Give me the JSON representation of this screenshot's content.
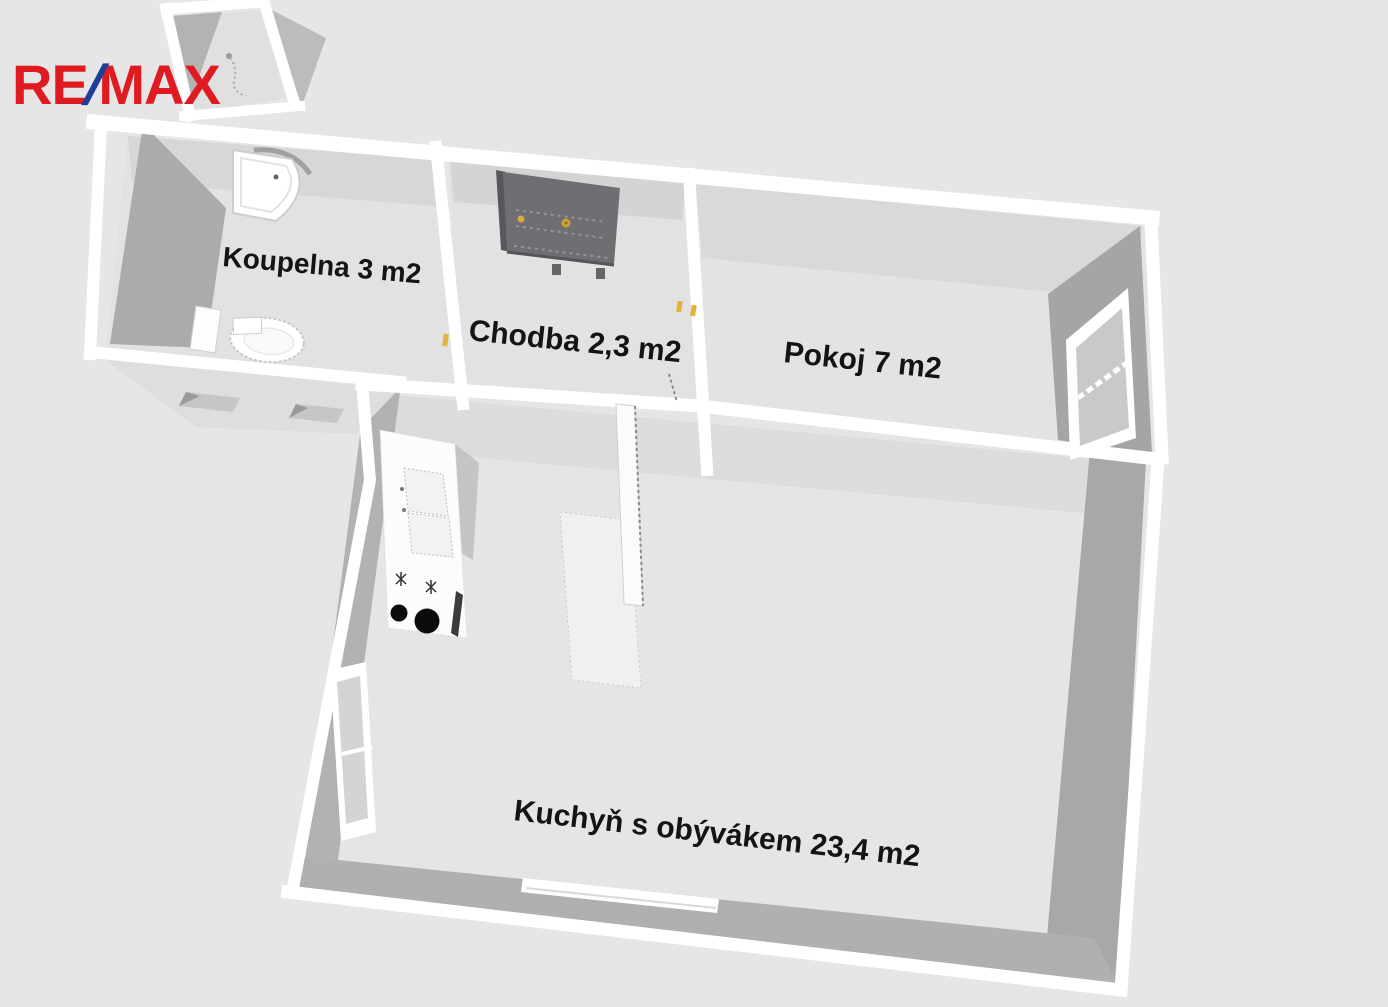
{
  "logo": {
    "re": "RE",
    "slash": "/",
    "max": "MAX"
  },
  "rooms": [
    {
      "name": "koupelna",
      "label": "Koupelna 3 m2"
    },
    {
      "name": "chodba",
      "label": "Chodba 2,3 m2"
    },
    {
      "name": "pokoj",
      "label": "Pokoj 7 m2"
    },
    {
      "name": "kuchyn-s-obyvakem",
      "label": "Kuchyň s obývákem 23,4 m2"
    }
  ],
  "fixtures": [
    "bathtub",
    "toilet",
    "bathroom-cabinet",
    "shower-sketch",
    "wardrobe",
    "kitchen-counter",
    "sink",
    "stove-burner-small",
    "stove-burner-large",
    "oven-handle",
    "kitchen-island",
    "open-door-leaf",
    "window-pokoj",
    "window-kitchen-left",
    "window-kitchen-bottom",
    "door-hinge-marker"
  ],
  "colors": {
    "background": "#e6e6e6",
    "floor": "#e3e3e3",
    "floor_shadow": "#d7d7d7",
    "wall_top": "#ffffff",
    "wall_face_dark": "#a9a9a9",
    "wall_face_mid": "#b2b2b2",
    "wardrobe": "#6f6f73",
    "burner_black": "#0b0b0b",
    "hinge_yellow": "#e2b23c",
    "logo_red": "#e01a21",
    "logo_blue": "#1b3f99",
    "label_text": "#141414"
  }
}
